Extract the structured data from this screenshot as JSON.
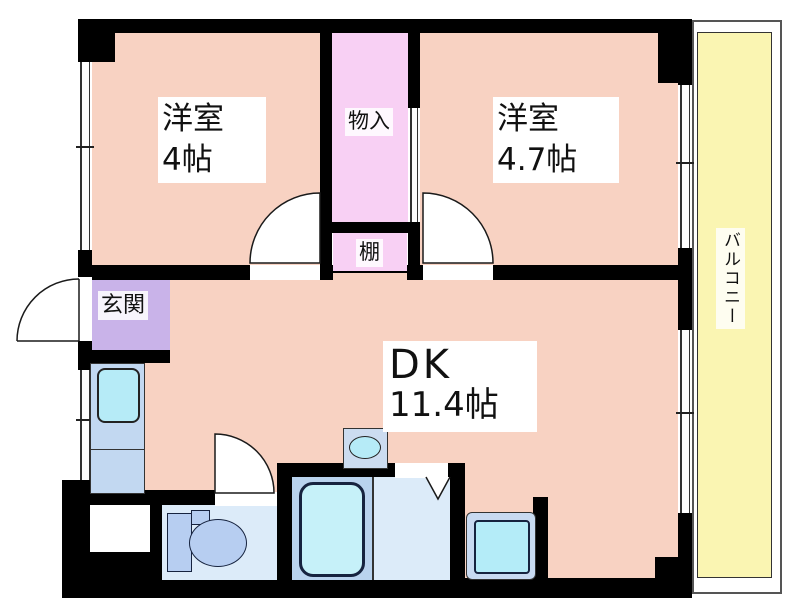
{
  "plan": {
    "type": "apartment-floorplan",
    "rooms": {
      "western1": {
        "name": "洋室",
        "size": "4帖"
      },
      "western2": {
        "name": "洋室",
        "size": "4.7帖"
      },
      "dining_kitchen": {
        "name": "DK",
        "size": "11.4帖"
      },
      "closet": {
        "label": "物入"
      },
      "shelf": {
        "label": "棚"
      },
      "entrance": {
        "label": "玄関"
      },
      "balcony": {
        "label": "バルコニー"
      }
    },
    "colors": {
      "room_fill": "#f8d2c2",
      "closet_fill": "#f8d0f4",
      "entrance_fill": "#c9b3e9",
      "balcony_fill": "#faf5b2",
      "wet_floor_light": "#dcebf9",
      "bath_floor": "#b9d3ee",
      "fixture_blue": "#b7cef1",
      "water_cyan": "#b6ebf7",
      "wall": "#000000"
    }
  }
}
